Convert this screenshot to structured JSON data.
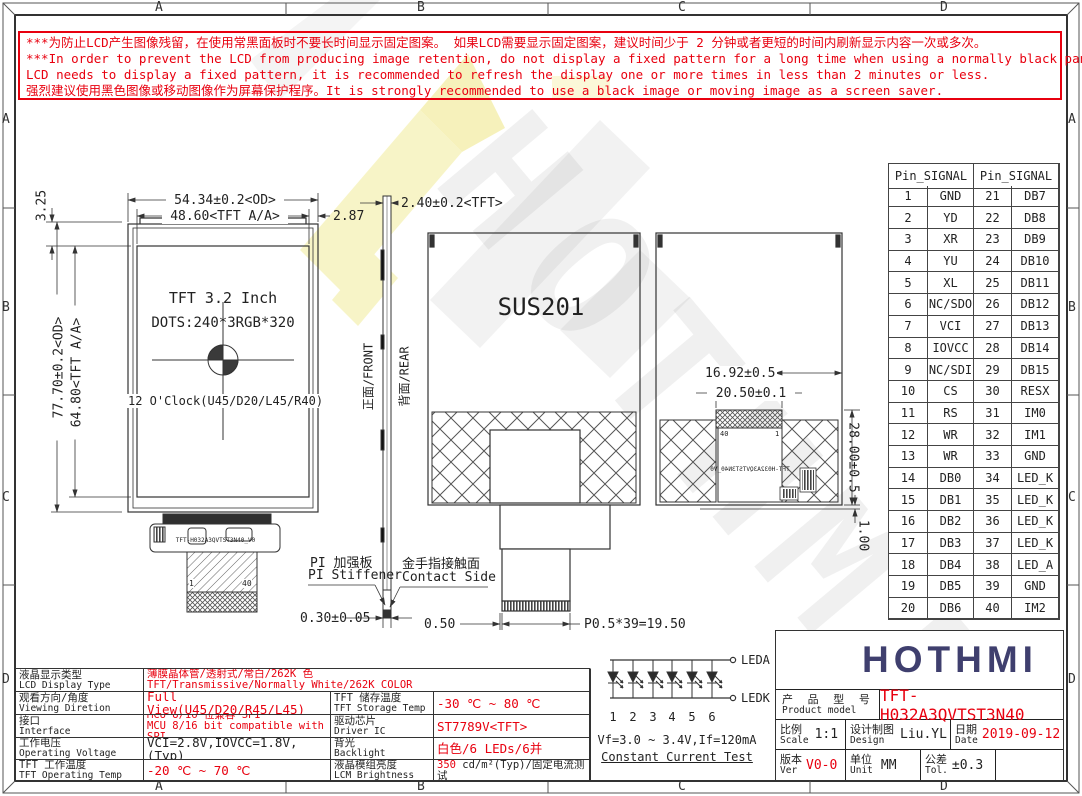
{
  "frame": {
    "zones": [
      "A",
      "B",
      "C",
      "D"
    ]
  },
  "warning": {
    "lines": [
      "***为防止LCD产生图像残留，在使用常黑面板时不要长时间显示固定图案。 如果LCD需要显示固定图案，建议时间少于 2 分钟或者更短的时间内刷新显示内容一次或多次。",
      "***In order to prevent the LCD from producing image retention, do not display a fixed pattern for a long time when using a normally black panel. If the",
      " LCD needs to display a fixed pattern, it is recommended to refresh the display one or more times in less than 2 minutes or less.",
      "强烈建议使用黑色图像或移动图像作为屏幕保护程序。It is strongly recommended to use a black image or moving image as a screen saver."
    ]
  },
  "views": {
    "front": {
      "dim_width_od": "54.34±0.2<OD>",
      "dim_width_aa": "48.60<TFT A/A>",
      "dim_right_gap": "2.87",
      "dim_top_gap": "3.25",
      "dim_height_aa": "64.80<TFT A/A>",
      "dim_height_od": "77.70±0.2<OD>",
      "line1": "TFT 3.2 Inch",
      "line2": "DOTS:240*3RGB*320",
      "line3": "12 O'Clock(U45/D20/L45/R40)",
      "fpc_text": "TFT-H032A3QVTST3N40_V0",
      "pin_first": "1",
      "pin_last": "40"
    },
    "side": {
      "dim_thickness": "2.40±0.2<TFT>",
      "front_label": "正面/FRONT",
      "rear_label": "背面/REAR",
      "stiffener_zh": "PI 加强板",
      "stiffener_en": "PI Stiffener",
      "contact_zh": "金手指接触面",
      "contact_en": "Contact Side",
      "dim_stiffener": "0.30±0.05"
    },
    "rear": {
      "shield": "SUS201",
      "dim_offset": "0.50",
      "dim_pitch": "P0.5*39=19.50"
    },
    "rear2": {
      "dim_width1": "16.92±0.5",
      "dim_width2": "20.50±0.1",
      "dim_height": "28.00±0.5",
      "dim_lip": "1.00",
      "fpc_text": "TFT-H032A3QVTST3N40_V0",
      "pin_last": "40",
      "pin_first": "1"
    }
  },
  "pin_table": {
    "header": "Pin_SIGNAL",
    "rows": [
      [
        "1",
        "GND",
        "21",
        "DB7"
      ],
      [
        "2",
        "YD",
        "22",
        "DB8"
      ],
      [
        "3",
        "XR",
        "23",
        "DB9"
      ],
      [
        "4",
        "YU",
        "24",
        "DB10"
      ],
      [
        "5",
        "XL",
        "25",
        "DB11"
      ],
      [
        "6",
        "NC/SDO",
        "26",
        "DB12"
      ],
      [
        "7",
        "VCI",
        "27",
        "DB13"
      ],
      [
        "8",
        "IOVCC",
        "28",
        "DB14"
      ],
      [
        "9",
        "NC/SDI",
        "29",
        "DB15"
      ],
      [
        "10",
        "CS",
        "30",
        "RESX"
      ],
      [
        "11",
        "RS",
        "31",
        "IM0"
      ],
      [
        "12",
        "WR",
        "32",
        "IM1"
      ],
      [
        "13",
        "WR",
        "33",
        "GND"
      ],
      [
        "14",
        "DB0",
        "34",
        "LED_K"
      ],
      [
        "15",
        "DB1",
        "35",
        "LED_K"
      ],
      [
        "16",
        "DB2",
        "36",
        "LED_K"
      ],
      [
        "17",
        "DB3",
        "37",
        "LED_K"
      ],
      [
        "18",
        "DB4",
        "38",
        "LED_A"
      ],
      [
        "19",
        "DB5",
        "39",
        "GND"
      ],
      [
        "20",
        "DB6",
        "40",
        "IM2"
      ]
    ]
  },
  "led_circuit": {
    "anode": "LEDA",
    "cathode": "LEDK",
    "numbers": [
      "1",
      "2",
      "3",
      "4",
      "5",
      "6"
    ],
    "vf": "Vf=3.0 ~ 3.4V,If=120mA",
    "test": "Constant Current Test"
  },
  "spec_table": {
    "rows": [
      {
        "label_zh": "液晶显示类型",
        "label_en": "LCD Display Type",
        "value_zh": "薄膜晶体管/透射式/常白/262K 色",
        "value_en": "TFT/Transmissive/Normally White/262K COLOR"
      },
      {
        "label_zh": "观看方向/角度",
        "label_en": "Viewing Diretion",
        "value": "Full View(U45/D20/R45/L45)",
        "label2_zh": "TFT 储存温度",
        "label2_en": "TFT Storage Temp",
        "value2": "-30 ℃ ~ 80 ℃"
      },
      {
        "label_zh": "接口",
        "label_en": "Interface",
        "value_zh": "MCU 8/16 位兼容 SPI",
        "value_en": "MCU 8/16 bit compatible with SPI",
        "label2_zh": "驱动芯片",
        "label2_en": "Driver IC",
        "value2": "ST7789V<TFT>"
      },
      {
        "label_zh": "工作电压",
        "label_en": "Operating Voltage",
        "value": "VCI=2.8V,IOVCC=1.8V,(Typ)",
        "label2_zh": "背光",
        "label2_en": "Backlight",
        "value2": "白色/6 LEDs/6并"
      },
      {
        "label_zh": "TFT 工作温度",
        "label_en": "TFT Operating Temp",
        "value": "-20 ℃ ~ 70 ℃",
        "label2_zh": "液晶模组亮度",
        "label2_en": "LCM Brightness",
        "value2_red": "350",
        "value2_black": " cd/m²(Typ)/固定电流测试"
      }
    ]
  },
  "title_block": {
    "brand": "HOTHMI",
    "model_label_zh": "产 品 型 号",
    "model_label_en": "Product model",
    "model_value": "TFT-H032A3QVTST3N40",
    "scale_zh": "比例",
    "scale_en": "Scale",
    "scale_value": "1:1",
    "design_zh": "设计制图",
    "design_en": "Design",
    "design_value": "Liu.YL",
    "date_zh": "日期",
    "date_en": "Date",
    "date_value": "2019-09-12",
    "ver_zh": "版本",
    "ver_en": "Ver",
    "ver_value": "V0-0",
    "unit_zh": "单位",
    "unit_en": "Unit",
    "unit_value": "MM",
    "tol_zh": "公差",
    "tol_en": "Tol.",
    "tol_value": "±0.3"
  }
}
